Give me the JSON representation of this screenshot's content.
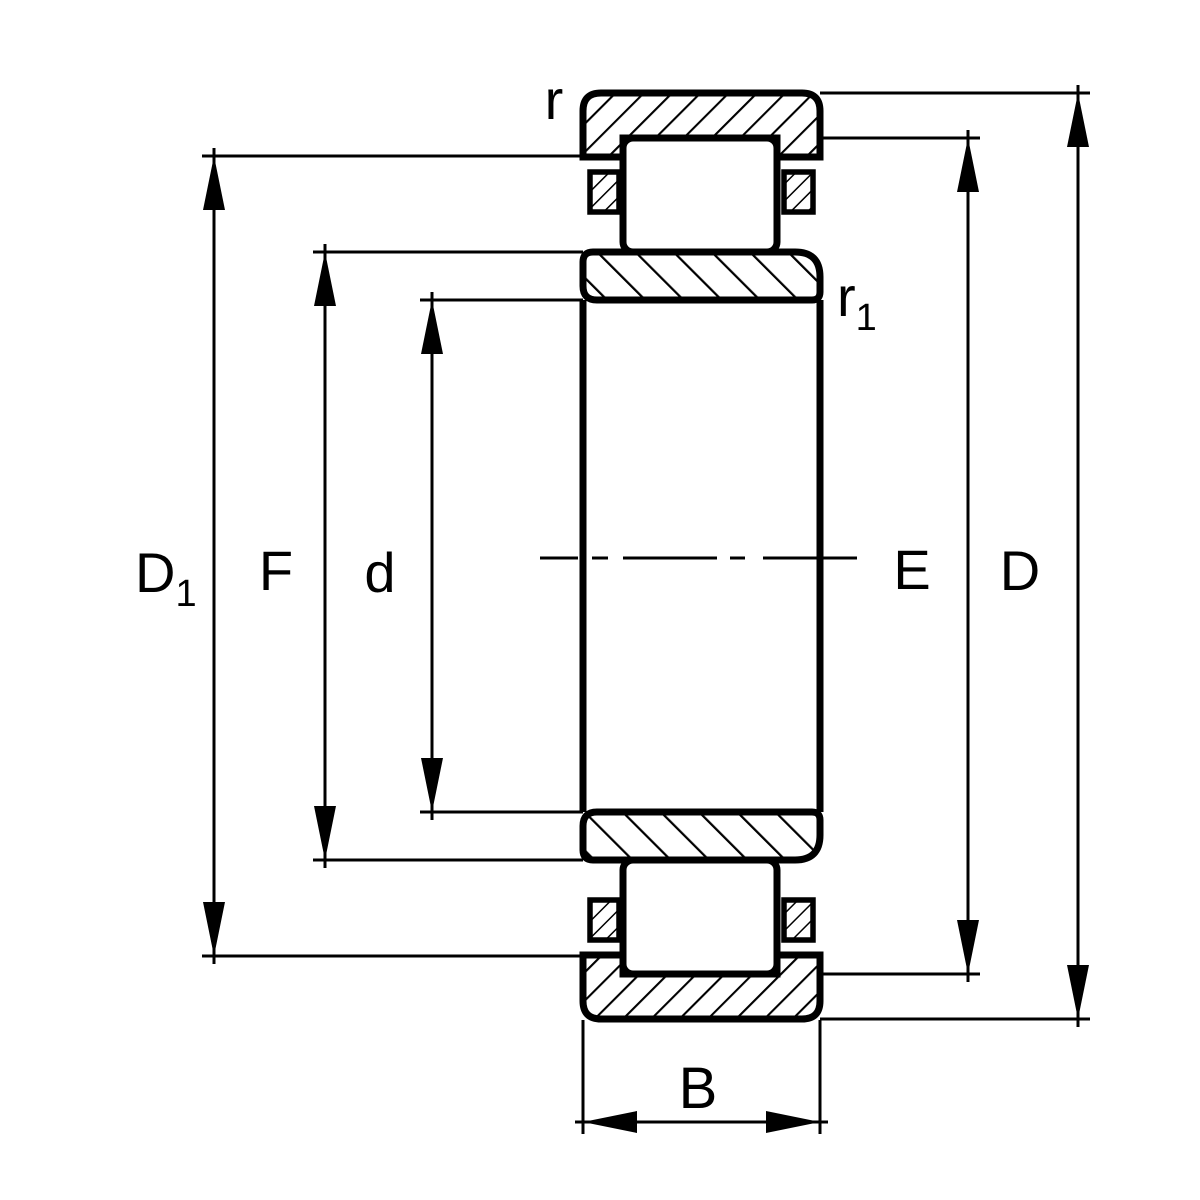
{
  "diagram": {
    "type": "technical-drawing",
    "subject": "Cylindrical roller bearing cross-section",
    "colors": {
      "line": "#000000",
      "background": "#ffffff"
    },
    "labels": {
      "r": "r",
      "r1_base": "r",
      "r1_sub": "1",
      "D1_base": "D",
      "D1_sub": "1",
      "F": "F",
      "d": "d",
      "E": "E",
      "D": "D",
      "B": "B"
    }
  }
}
